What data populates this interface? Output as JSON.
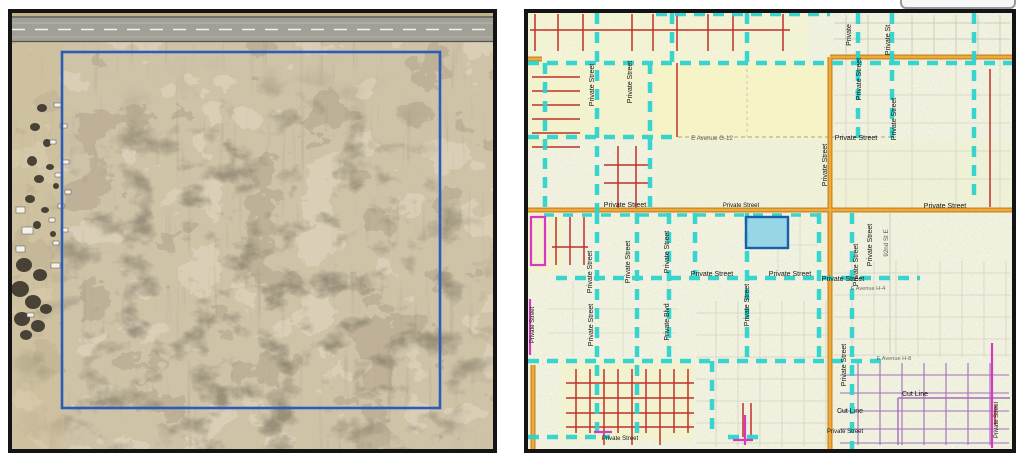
{
  "document": {
    "background_color": "#ffffff",
    "panel_border_color": "#141414"
  },
  "ui_fragment": {
    "description_color": "#999999"
  },
  "aerial_panel": {
    "boundary_outline_color": "#2a5cb8",
    "road_color": "#a29f97",
    "terrain_base_color": "#b9a87f"
  },
  "map_panel": {
    "highlight_parcel_fill": "#8ed3e6",
    "highlight_parcel_outline": "#1b5ea9",
    "private_street_line_color": "#2ed2cd",
    "road_color": "#e8a030",
    "lot_line_color": "#c03028",
    "cut_line_color": "#9a5fb5",
    "magenta_line_color": "#d837c0",
    "labels": {
      "private_street": "Private Street",
      "private_st": "Private St",
      "private": "Private",
      "private_blvd": "Private Blvd",
      "avenue_g12": "E Avenue G-12",
      "avenue_h4": "E Avenue H-4",
      "avenue_h8": "E Avenue H-8",
      "street_92": "92nd St E",
      "cut_line": "Cut Line"
    }
  }
}
